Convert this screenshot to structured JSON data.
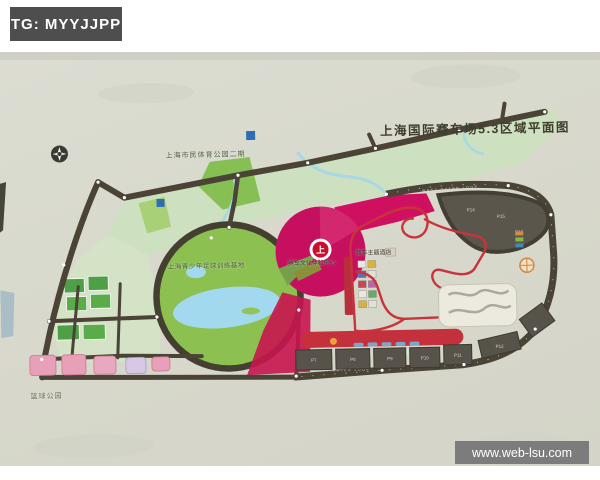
{
  "badge": {
    "text": "TG: MYYJJPP",
    "bg": "#4e4e4e",
    "color": "#ffffff"
  },
  "watermark": {
    "text": "www.web-lsu.com",
    "bg": "#7c7c7c",
    "color": "#ffffff"
  },
  "map": {
    "title": "上海国际赛车场5.3区域平面图",
    "labels": [
      {
        "id": "citizen-sports-park",
        "text": "上海市民体育公园二期"
      },
      {
        "id": "youth-football-base",
        "text": "上海青少年足球训练基地"
      },
      {
        "id": "racing-culture-center",
        "text": "赛车文化体验中心"
      },
      {
        "id": "racing-theme-hotel",
        "text": "赛车主题酒店"
      },
      {
        "id": "basketball-park",
        "text": "篮球公园"
      }
    ],
    "road_labels": {
      "top_loop": "WEST OUTER LOOP",
      "bottom_loop": "WEST OUTER LOOP"
    },
    "parking": {
      "bottom": [
        "P7",
        "P8",
        "P9",
        "P10",
        "P11",
        "P12"
      ],
      "top": [
        "P14",
        "P15",
        "P16"
      ]
    },
    "colors": {
      "photo_bg": "#d9dacd",
      "road": "#4a4336",
      "park_light": "#cde0bf",
      "park_bright": "#8cc152",
      "water": "#a2d9ee",
      "magenta_zone": "#c60f5e",
      "red_zone": "#c4303c",
      "track_line": "#c8333c",
      "parking_lot": "#57524a",
      "title_text": "#3f3d2c"
    }
  }
}
